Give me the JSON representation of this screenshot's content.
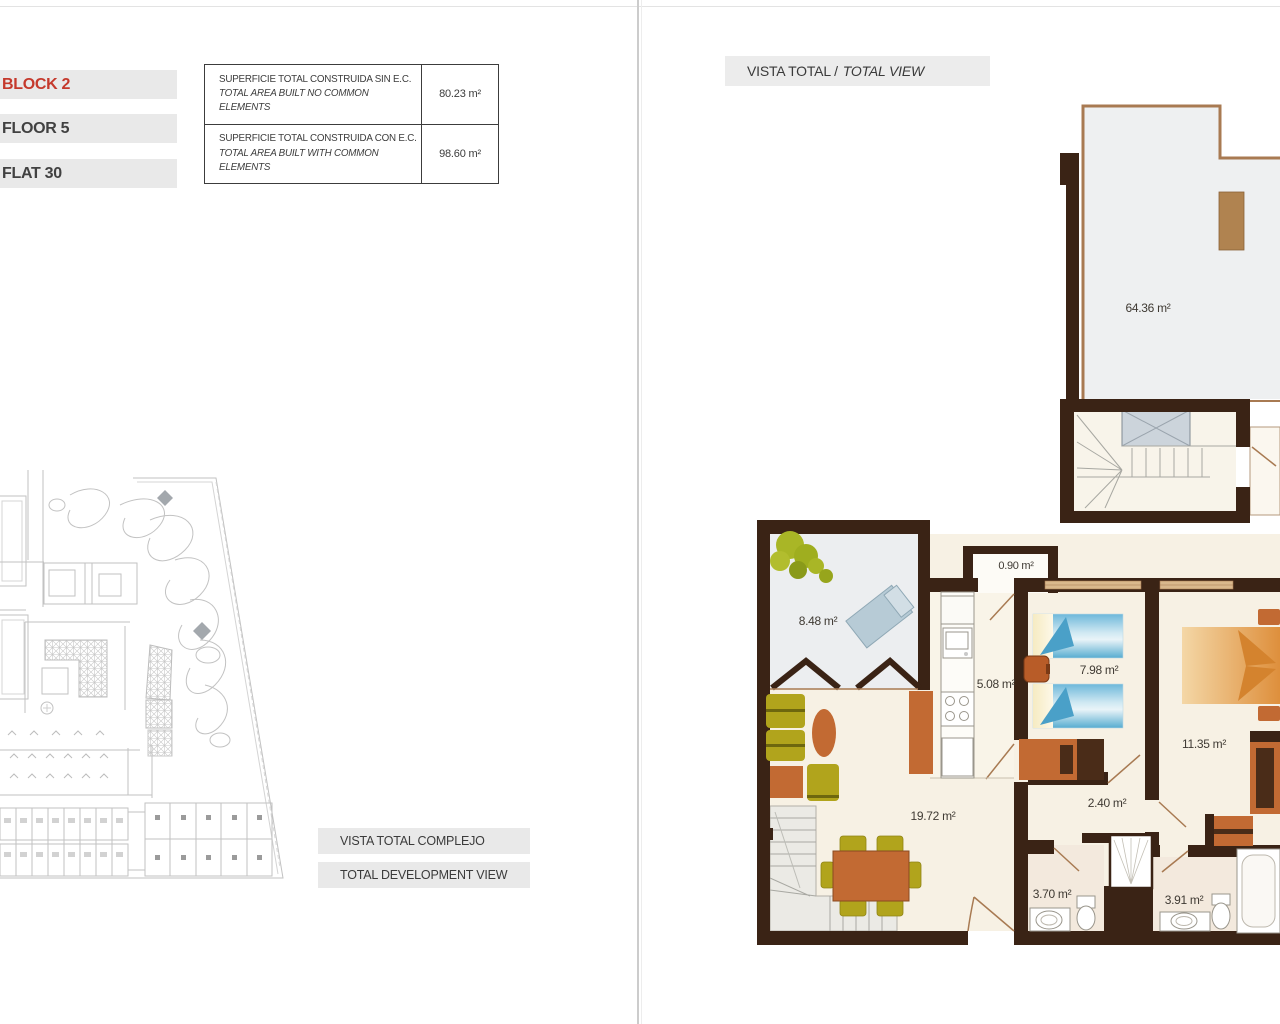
{
  "left_page": {
    "unit_labels": [
      {
        "text": "BLOCK 2"
      },
      {
        "text": "FLOOR 5"
      },
      {
        "text": "FLAT 30"
      }
    ],
    "area_table": {
      "rows": [
        {
          "title_es": "SUPERFICIE TOTAL CONSTRUIDA SIN E.C.",
          "title_en": "TOTAL AREA BUILT NO COMMON ELEMENTS",
          "value": "80.23 m²"
        },
        {
          "title_es": "SUPERFICIE TOTAL CONSTRUIDA CON E.C.",
          "title_en": "TOTAL AREA BUILT WITH COMMON ELEMENTS",
          "value": "98.60 m²"
        }
      ]
    },
    "site_captions": [
      {
        "text": "VISTA TOTAL COMPLEJO"
      },
      {
        "text": "TOTAL DEVELOPMENT VIEW"
      }
    ]
  },
  "right_page": {
    "header_es": "VISTA TOTAL /",
    "header_en": "TOTAL VIEW",
    "room_areas": {
      "solarium": "64.36 m²",
      "storage": "0.90 m²",
      "terrace": "8.48 m²",
      "kitchen": "5.08 m²",
      "bedroom_2": "7.98 m²",
      "bedroom_1": "11.35 m²",
      "living_room": "19.72 m²",
      "hallway": "2.40 m²",
      "bathroom_1": "3.70 m²",
      "bathroom_2": "3.91 m²"
    }
  },
  "colors": {
    "accent_red": "#c5392c",
    "label_bar_gray": "#e9e9e9",
    "wall_brown": "#3a2315",
    "thin_wall_brown": "#a87a52",
    "furniture_orange": "#c26a33",
    "furniture_olive": "#b1a41c",
    "bed_blue": "#5fb0d4",
    "floor_cream": "#f7f1e4",
    "terrace_gray": "#eef0f1",
    "site_line_gray": "#c2c2c2"
  }
}
